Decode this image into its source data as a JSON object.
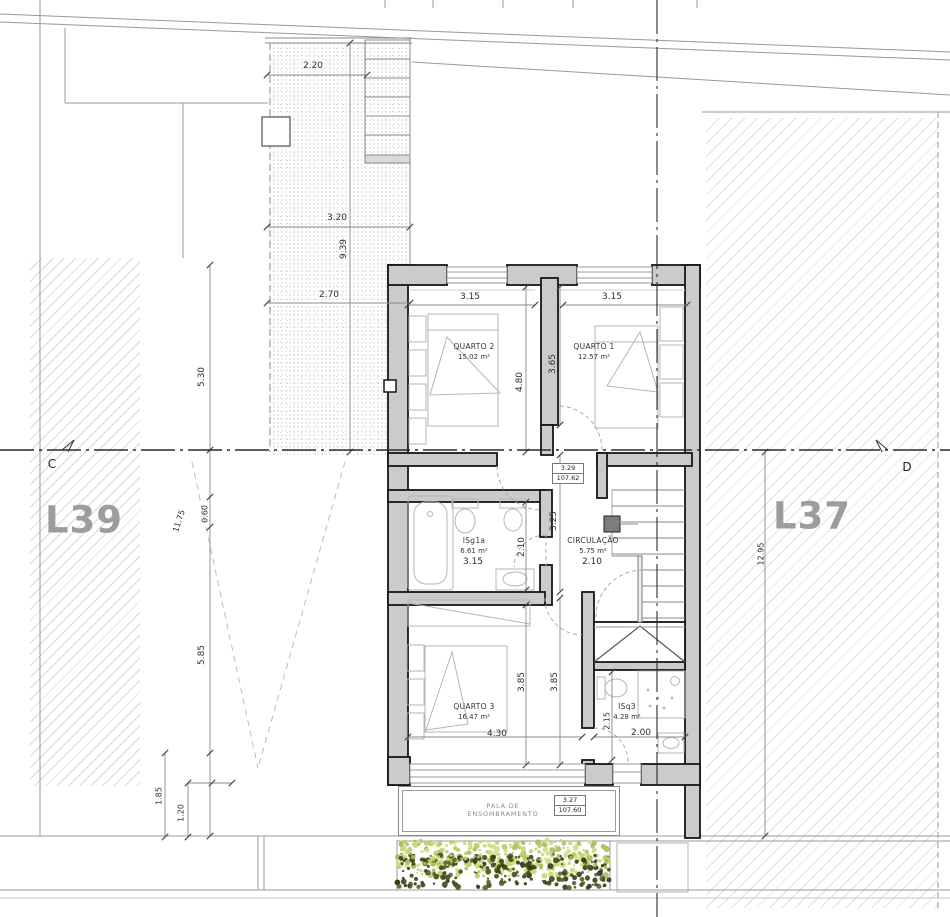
{
  "plan": {
    "lots": {
      "left": "L39",
      "right": "L37"
    },
    "sections": {
      "left": "C",
      "right": "D"
    },
    "rooms": [
      {
        "name": "QUARTO 2",
        "area": "15.02 m²"
      },
      {
        "name": "QUARTO 1",
        "area": "12.57 m²"
      },
      {
        "name": "ISg1a",
        "area": "6.61 m²"
      },
      {
        "name": "CIRCULAÇÃO",
        "area": "5.75 m²"
      },
      {
        "name": "QUARTO 3",
        "area": "16.47 m²"
      },
      {
        "name": "ISq3",
        "area": "4.28 m²"
      }
    ],
    "levels": [
      {
        "height": "3.29",
        "elevation": "107.62"
      },
      {
        "height": "3.27",
        "elevation": "107.60"
      }
    ],
    "canopy": {
      "line1": "PALA DE",
      "line2": "ENSOMBRAMENTO"
    },
    "dims": {
      "d220": "2.20",
      "d320": "3.20",
      "d939": "9.39",
      "d270": "2.70",
      "d315_q2": "3.15",
      "d315_q1": "3.15",
      "d480": "4.80",
      "d365": "3.65",
      "d325": "3.25",
      "d210_bath": "2.10",
      "d315_bath": "3.15",
      "d210_circ": "2.10",
      "d385_a": "3.85",
      "d385_b": "3.85",
      "d430": "4.30",
      "d215": "2.15",
      "d200": "2.00",
      "d530": "5.30",
      "d060": "0.60",
      "d1175": "11.75",
      "d585": "5.85",
      "d185": "1.85",
      "d120": "1.20",
      "d1295": "12.95"
    }
  }
}
